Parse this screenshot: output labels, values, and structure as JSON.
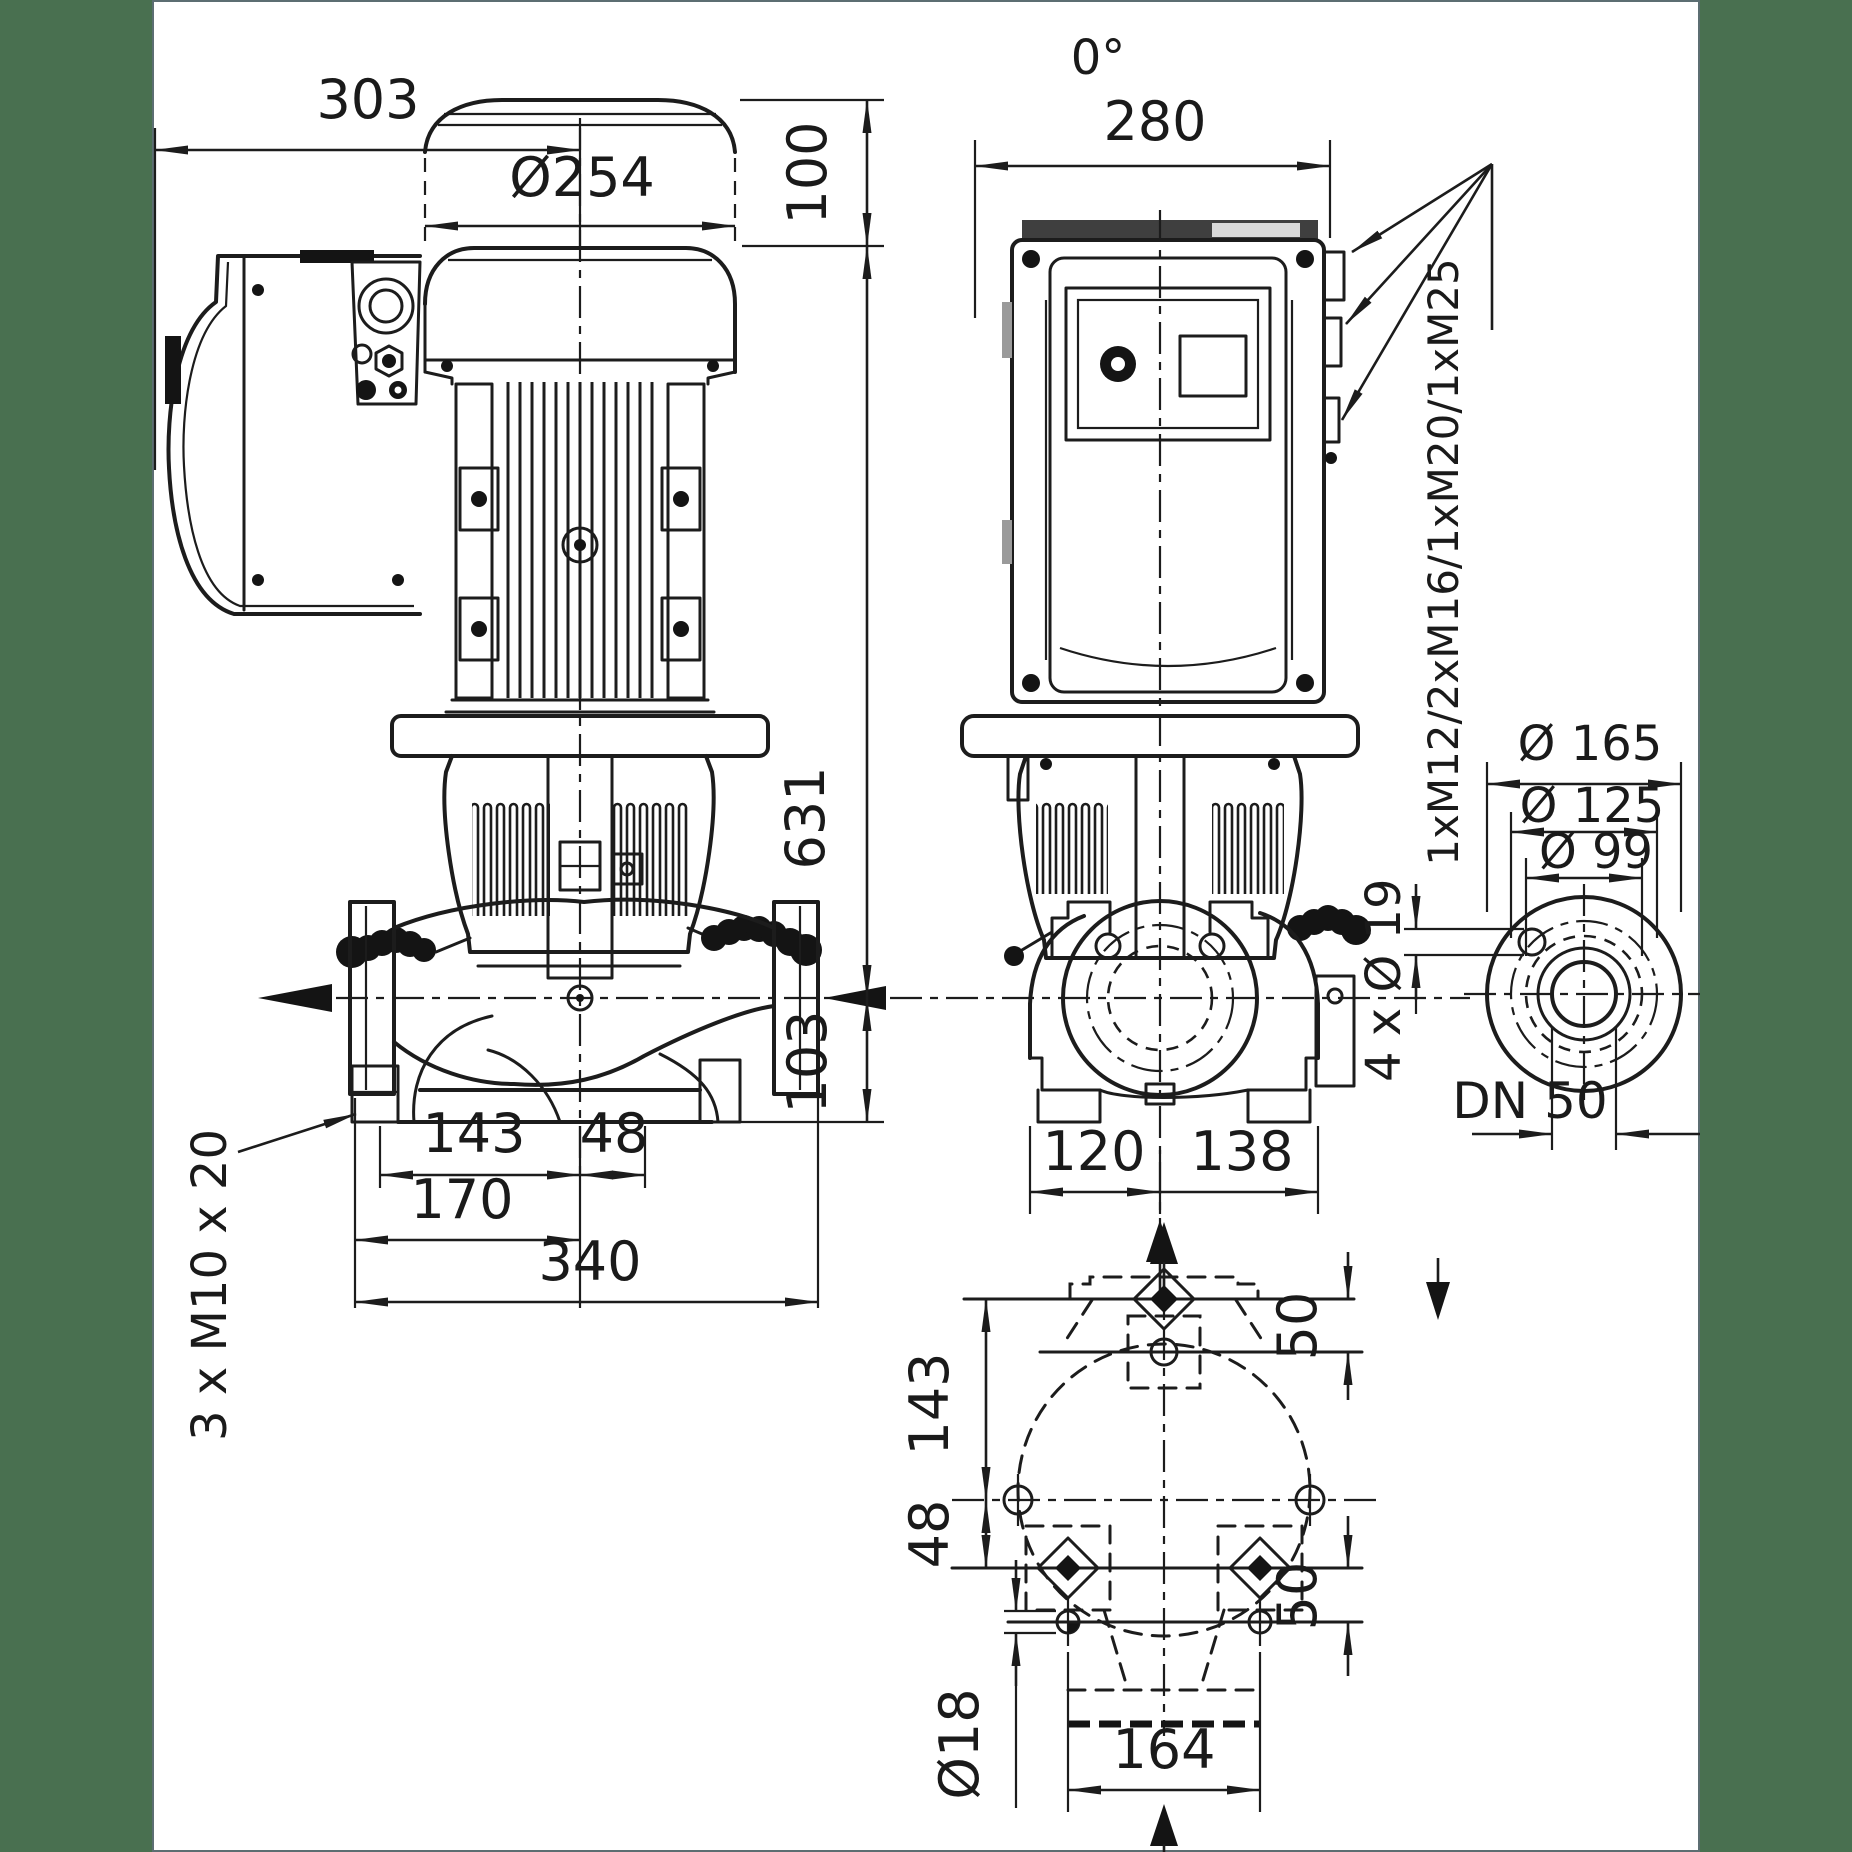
{
  "drawing": {
    "type": "pump_dimensional_drawing",
    "background_color": "#ffffff",
    "margin_band_color": "#497050",
    "line_color": "#1c1c1c",
    "front_view": {
      "dims": {
        "width_to_axis": "303",
        "motor_diameter": "Ø254",
        "cap_height": "100",
        "axis_height": "631",
        "base_below_axis": "103",
        "foot_left_of_axis": "143",
        "foot_right_of_axis": "48",
        "flange_to_axis": "170",
        "overall_length": "340"
      },
      "labels": {
        "foot_thread": "3 x M10 x 20"
      }
    },
    "side_view": {
      "labels": {
        "orientation": "0°",
        "cable_glands": "1xM12/2xM16/1xM20/1xM25"
      },
      "dims": {
        "module_width": "280",
        "axis_left": "120",
        "axis_right": "138"
      }
    },
    "flange_detail": {
      "dims": {
        "outer_diameter": "Ø 165",
        "bolt_circle": "Ø 125",
        "raised_face": "Ø 99"
      },
      "labels": {
        "bolt_holes": "4 x Ø 19",
        "nominal_bore": "DN 50"
      }
    },
    "plan_view": {
      "dims": {
        "flange_to_holes": "143",
        "holes_to_feet": "48",
        "port_to_hole": "50",
        "foot_to_hole": "50",
        "hole_diameter": "Ø18",
        "feet_spacing": "164"
      }
    }
  }
}
